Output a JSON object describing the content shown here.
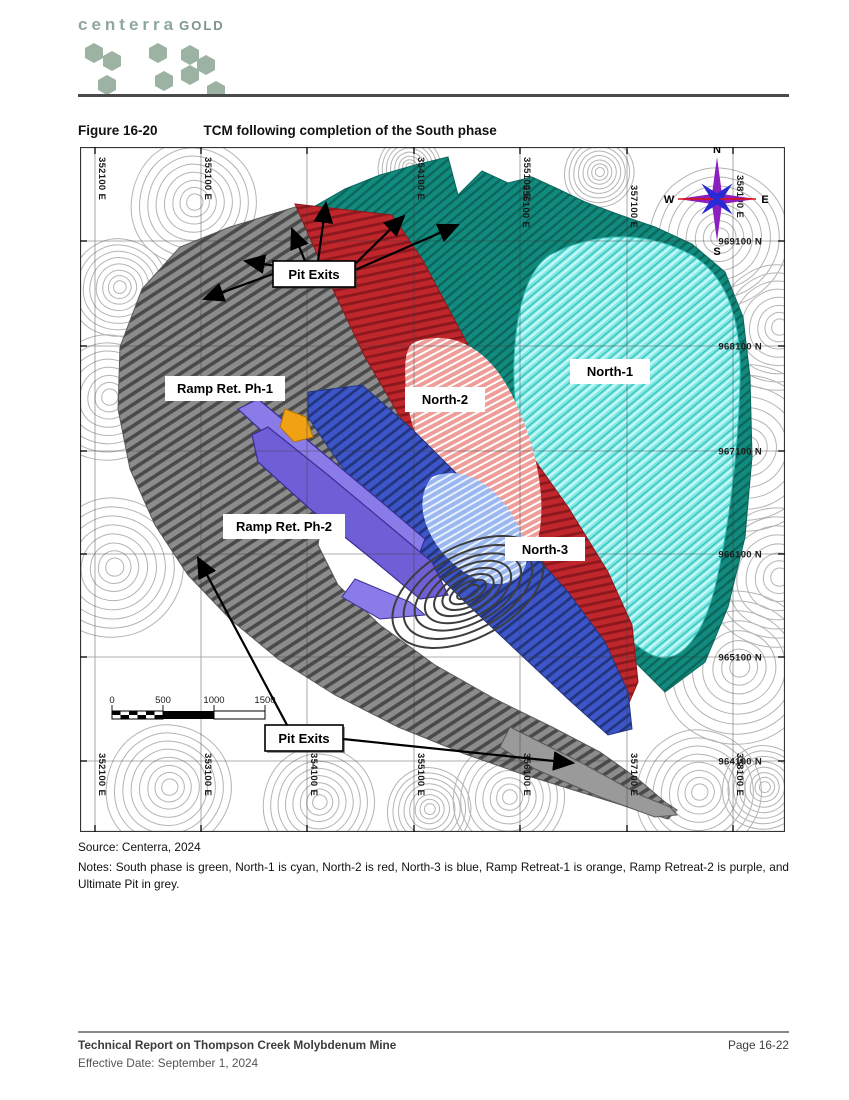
{
  "header": {
    "logo_word": "centerra",
    "logo_word2": "GOLD"
  },
  "figure": {
    "label": "Figure 16-20",
    "title": "TCM following completion of the South phase"
  },
  "map": {
    "eastings": [
      "352100 E",
      "353100 E",
      "354100 E",
      "355100 E",
      "356100 E",
      "357100 E",
      "358100 E"
    ],
    "northings": [
      "969100 N",
      "968100 N",
      "967100 N",
      "966100 N",
      "965100 N",
      "964100 N"
    ],
    "labels": {
      "pit_exits": "Pit Exits",
      "ramp1": "Ramp Ret. Ph-1",
      "ramp2": "Ramp Ret. Ph-2",
      "north1": "North-1",
      "north2": "North-2",
      "north3": "North-3"
    },
    "compass": {
      "n": "N",
      "e": "E",
      "s": "S",
      "w": "W"
    },
    "scale_ticks": [
      "0",
      "500",
      "1000",
      "1500"
    ],
    "colors": {
      "south_green": "#128a7e",
      "north1_cyan": "#7fe9e6",
      "north2_red": "#c0272d",
      "north3_blue": "#3c55c8",
      "ramp1_orange": "#f0a114",
      "ramp2_purple": "#7c6ede",
      "ultimate_grey": "#8c8c8c",
      "pink_highwall": "#ee9d99",
      "lightblue_highwall": "#9ab7f0"
    }
  },
  "source": "Source: Centerra, 2024",
  "notes": "Notes: South phase is green, North-1 is cyan, North-2 is red, North-3 is blue, Ramp Retreat-1 is orange, Ramp Retreat-2 is purple, and Ultimate Pit in grey.",
  "footer": {
    "title": "Technical Report on Thompson Creek Molybdenum Mine",
    "date": "Effective Date: September 1, 2024",
    "page": "Page 16-22"
  }
}
